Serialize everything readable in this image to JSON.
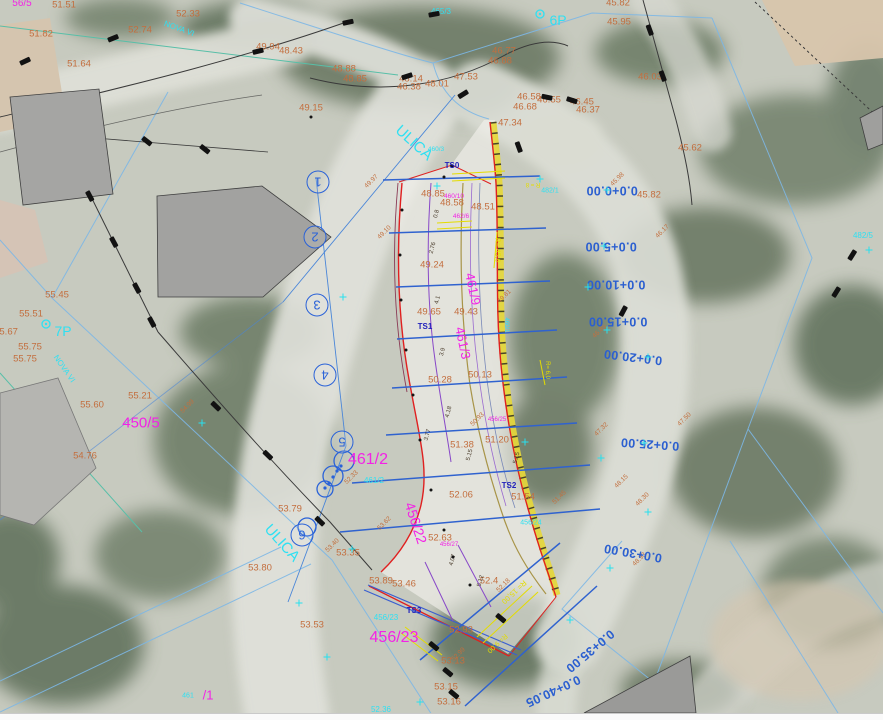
{
  "map": {
    "palette": {
      "station_blue": "#2b5fd0",
      "elevation_orange": "#c36e3e",
      "parcel_magenta": "#f322e6",
      "parcel_cyan": "#2fe0f2",
      "design_red": "#e02020",
      "highlight_yellow": "#e5d73a",
      "control_navy": "#2121bb"
    },
    "labels": {
      "streets": [
        {
          "t": "ULICA",
          "x": 414,
          "y": 143,
          "r": 42
        },
        {
          "t": "ULICA",
          "x": 282,
          "y": 543,
          "r": 48
        },
        {
          "t": "NOVA VI",
          "x": 179,
          "y": 29,
          "r": 20,
          "s": 8
        },
        {
          "t": "NOVA VI",
          "x": 64,
          "y": 369,
          "r": 55,
          "s": 8
        }
      ],
      "named_points": [
        {
          "t": "7P",
          "x": 63,
          "y": 331
        },
        {
          "t": "6P",
          "x": 558,
          "y": 20
        }
      ],
      "parcels_cyan": [
        {
          "t": "465/3",
          "x": 441,
          "y": 12
        },
        {
          "t": "482/5",
          "x": 863,
          "y": 236
        },
        {
          "t": "482/1",
          "x": 550,
          "y": 191,
          "s": 7
        },
        {
          "t": "461/2",
          "x": 374,
          "y": 481
        },
        {
          "t": "456/23",
          "x": 386,
          "y": 618
        },
        {
          "t": "456/24",
          "x": 531,
          "y": 523,
          "s": 7
        },
        {
          "t": "461",
          "x": 188,
          "y": 696,
          "s": 7
        },
        {
          "t": "52.36",
          "x": 381,
          "y": 710
        },
        {
          "t": "460/1",
          "x": 506,
          "y": 325,
          "r": 90,
          "s": 6
        },
        {
          "t": "460/3",
          "x": 436,
          "y": 150,
          "s": 6.5
        }
      ],
      "parcels_magenta": [
        {
          "t": "450/5",
          "x": 141,
          "y": 423
        },
        {
          "t": "461/2",
          "x": 368,
          "y": 460,
          "s": 16
        },
        {
          "t": "456/22",
          "x": 416,
          "y": 523,
          "s": 14,
          "r": 72
        },
        {
          "t": "456/23",
          "x": 394,
          "y": 638,
          "s": 16
        },
        {
          "t": "461/9",
          "x": 473,
          "y": 289,
          "s": 13,
          "r": 78
        },
        {
          "t": "461/3",
          "x": 463,
          "y": 343,
          "s": 13,
          "r": 78
        },
        {
          "t": "460/10",
          "x": 454,
          "y": 197,
          "s": 6.5
        },
        {
          "t": "462/6",
          "x": 461,
          "y": 217,
          "s": 6.5
        },
        {
          "t": "456/27",
          "x": 449,
          "y": 545,
          "s": 6
        },
        {
          "t": "456/25",
          "x": 497,
          "y": 420,
          "s": 6
        },
        {
          "t": "/1",
          "x": 208,
          "y": 695,
          "s": 13
        },
        {
          "t": "56/5",
          "x": 22,
          "y": 4,
          "s": 10
        }
      ],
      "spot_elevations": [
        {
          "t": "51.51",
          "x": 64,
          "y": 5
        },
        {
          "t": "52.33",
          "x": 188,
          "y": 14
        },
        {
          "t": "52.74",
          "x": 140,
          "y": 30
        },
        {
          "t": "51.82",
          "x": 41,
          "y": 34
        },
        {
          "t": "51.64",
          "x": 79,
          "y": 64
        },
        {
          "t": "49.94",
          "x": 268,
          "y": 47
        },
        {
          "t": "48.43",
          "x": 291,
          "y": 51
        },
        {
          "t": "48.88",
          "x": 344,
          "y": 69
        },
        {
          "t": "48.85",
          "x": 355,
          "y": 79
        },
        {
          "t": "48.14",
          "x": 411,
          "y": 79
        },
        {
          "t": "46.38",
          "x": 409,
          "y": 87
        },
        {
          "t": "48.01",
          "x": 437,
          "y": 84
        },
        {
          "t": "47.53",
          "x": 466,
          "y": 77
        },
        {
          "t": "46.77",
          "x": 504,
          "y": 51
        },
        {
          "t": "46.88",
          "x": 500,
          "y": 61
        },
        {
          "t": "49.15",
          "x": 311,
          "y": 108
        },
        {
          "t": "46.58",
          "x": 529,
          "y": 97
        },
        {
          "t": "46.55",
          "x": 549,
          "y": 100
        },
        {
          "t": "46.45",
          "x": 582,
          "y": 102
        },
        {
          "t": "46.68",
          "x": 525,
          "y": 107
        },
        {
          "t": "46.37",
          "x": 588,
          "y": 110
        },
        {
          "t": "47.34",
          "x": 510,
          "y": 123
        },
        {
          "t": "45.82",
          "x": 618,
          "y": 3
        },
        {
          "t": "45.95",
          "x": 619,
          "y": 22
        },
        {
          "t": "46.03",
          "x": 650,
          "y": 77
        },
        {
          "t": "45.62",
          "x": 690,
          "y": 148
        },
        {
          "t": "45.82",
          "x": 649,
          "y": 195
        },
        {
          "t": "48.85",
          "x": 433,
          "y": 194
        },
        {
          "t": "48.58",
          "x": 452,
          "y": 203
        },
        {
          "t": "48.51",
          "x": 483,
          "y": 207
        },
        {
          "t": "49.24",
          "x": 432,
          "y": 265
        },
        {
          "t": "49.65",
          "x": 429,
          "y": 312
        },
        {
          "t": "49.43",
          "x": 466,
          "y": 312
        },
        {
          "t": "50.28",
          "x": 440,
          "y": 380
        },
        {
          "t": "50.13",
          "x": 480,
          "y": 375
        },
        {
          "t": "51.38",
          "x": 462,
          "y": 445
        },
        {
          "t": "51.20",
          "x": 497,
          "y": 440
        },
        {
          "t": "52.06",
          "x": 461,
          "y": 495
        },
        {
          "t": "51.54",
          "x": 523,
          "y": 497
        },
        {
          "t": "52.63",
          "x": 440,
          "y": 538
        },
        {
          "t": "53.35",
          "x": 348,
          "y": 553
        },
        {
          "t": "53.79",
          "x": 290,
          "y": 509
        },
        {
          "t": "53.80",
          "x": 260,
          "y": 568
        },
        {
          "t": "53.89",
          "x": 381,
          "y": 581
        },
        {
          "t": "53.46",
          "x": 404,
          "y": 584
        },
        {
          "t": "52.4",
          "x": 489,
          "y": 581
        },
        {
          "t": "52.93",
          "x": 461,
          "y": 630
        },
        {
          "t": "53.13",
          "x": 453,
          "y": 661
        },
        {
          "t": "53.15",
          "x": 446,
          "y": 687
        },
        {
          "t": "53.16",
          "x": 449,
          "y": 702
        },
        {
          "t": "53.53",
          "x": 312,
          "y": 625
        },
        {
          "t": "55.45",
          "x": 57,
          "y": 295
        },
        {
          "t": "55.51",
          "x": 31,
          "y": 314
        },
        {
          "t": "55.67",
          "x": 6,
          "y": 332
        },
        {
          "t": "55.75",
          "x": 30,
          "y": 347
        },
        {
          "t": "55.75",
          "x": 25,
          "y": 359
        },
        {
          "t": "55.60",
          "x": 92,
          "y": 405
        },
        {
          "t": "55.21",
          "x": 140,
          "y": 396
        },
        {
          "t": "54.76",
          "x": 85,
          "y": 456
        }
      ],
      "minor_marks": [
        {
          "t": "49.97",
          "x": 372,
          "y": 182
        },
        {
          "t": "49.10",
          "x": 385,
          "y": 233
        },
        {
          "t": "49.81",
          "x": 505,
          "y": 297
        },
        {
          "t": "50.93",
          "x": 478,
          "y": 420
        },
        {
          "t": "47.32",
          "x": 602,
          "y": 430
        },
        {
          "t": "48.15",
          "x": 622,
          "y": 482
        },
        {
          "t": "48.30",
          "x": 643,
          "y": 500
        },
        {
          "t": "52.33",
          "x": 352,
          "y": 478
        },
        {
          "t": "53.40",
          "x": 333,
          "y": 546
        },
        {
          "t": "52.99",
          "x": 459,
          "y": 655
        },
        {
          "t": "52.18",
          "x": 504,
          "y": 586
        },
        {
          "t": "45.98",
          "x": 618,
          "y": 180
        },
        {
          "t": "46.17",
          "x": 663,
          "y": 232
        },
        {
          "t": "47.50",
          "x": 685,
          "y": 420
        },
        {
          "t": "46.85",
          "x": 600,
          "y": 332
        },
        {
          "t": "51.45",
          "x": 560,
          "y": 498
        },
        {
          "t": "48.93",
          "x": 640,
          "y": 560
        },
        {
          "t": "54.99",
          "x": 188,
          "y": 407
        },
        {
          "t": "53.62",
          "x": 385,
          "y": 524
        }
      ],
      "distance_marks": [
        {
          "t": "0.8",
          "x": 437,
          "y": 214
        },
        {
          "t": "2.76",
          "x": 433,
          "y": 248
        },
        {
          "t": "4.1",
          "x": 438,
          "y": 300
        },
        {
          "t": "3.9",
          "x": 443,
          "y": 352
        },
        {
          "t": "4.18",
          "x": 449,
          "y": 412
        },
        {
          "t": "3.77",
          "x": 428,
          "y": 435
        },
        {
          "t": "5.15",
          "x": 470,
          "y": 455
        },
        {
          "t": "5.15",
          "x": 517,
          "y": 458
        },
        {
          "t": "4.07",
          "x": 453,
          "y": 560
        },
        {
          "t": "5.12",
          "x": 481,
          "y": 581
        }
      ],
      "stations": [
        {
          "t": "0.0+0.00",
          "x": 612,
          "y": 190
        },
        {
          "t": "0.0+5.00",
          "x": 611,
          "y": 246
        },
        {
          "t": "0.0+10.00",
          "x": 616,
          "y": 284
        },
        {
          "t": "0.0+15.00",
          "x": 618,
          "y": 321
        },
        {
          "t": "0.0+20.00",
          "x": 633,
          "y": 357,
          "r": 187
        },
        {
          "t": "0.0+25.00",
          "x": 650,
          "y": 444,
          "r": 184
        },
        {
          "t": "0.0+30.00",
          "x": 633,
          "y": 553,
          "r": 190
        },
        {
          "t": "0.0+35.00",
          "x": 590,
          "y": 651,
          "r": 140
        },
        {
          "t": "0.0+40.05",
          "x": 553,
          "y": 691,
          "r": 155
        }
      ],
      "control_points": [
        {
          "t": "TS0",
          "x": 452,
          "y": 166
        },
        {
          "t": "TS1",
          "x": 425,
          "y": 327
        },
        {
          "t": "TS2",
          "x": 509,
          "y": 486
        },
        {
          "t": "TS3",
          "x": 414,
          "y": 611
        }
      ],
      "section_numbers": [
        {
          "t": "1",
          "x": 318,
          "y": 182
        },
        {
          "t": "2",
          "x": 315,
          "y": 237
        },
        {
          "t": "3",
          "x": 317,
          "y": 305
        },
        {
          "t": "4",
          "x": 325,
          "y": 375
        },
        {
          "t": "5",
          "x": 342,
          "y": 442
        },
        {
          "t": "6",
          "x": 302,
          "y": 535
        }
      ],
      "yellow_annotations": [
        {
          "t": "R= 45,6",
          "x": 497,
          "y": 250,
          "r": 90
        },
        {
          "t": "R = 8",
          "x": 533,
          "y": 184,
          "r": 180,
          "s": 6
        },
        {
          "t": "R= 15,00",
          "x": 514,
          "y": 592,
          "r": 137,
          "s": 7.5
        },
        {
          "t": "R= 9,00",
          "x": 497,
          "y": 643,
          "r": 137
        },
        {
          "t": "R= 6,0",
          "x": 547,
          "y": 370,
          "r": 90,
          "s": 6
        }
      ]
    },
    "symbols": {
      "survey_marks": [
        [
          113,
          38,
          -22
        ],
        [
          25,
          61,
          -25
        ],
        [
          258,
          51,
          -13
        ],
        [
          348,
          22,
          -12
        ],
        [
          434,
          14,
          -10
        ],
        [
          407,
          76,
          -18
        ],
        [
          463,
          94,
          -32
        ],
        [
          519,
          147,
          70
        ],
        [
          547,
          97,
          12
        ],
        [
          572,
          100,
          18
        ],
        [
          650,
          30,
          70
        ],
        [
          663,
          76,
          70
        ],
        [
          147,
          141,
          38
        ],
        [
          205,
          149,
          38
        ],
        [
          90,
          196,
          62
        ],
        [
          114,
          242,
          62
        ],
        [
          137,
          288,
          62
        ],
        [
          152,
          322,
          62
        ],
        [
          216,
          406,
          44
        ],
        [
          268,
          455,
          44
        ],
        [
          320,
          521,
          44
        ],
        [
          434,
          646,
          40
        ],
        [
          448,
          672,
          40
        ],
        [
          454,
          694,
          40
        ],
        [
          501,
          618,
          40
        ],
        [
          836,
          292,
          -58
        ],
        [
          852,
          255,
          -58
        ],
        [
          623,
          311,
          -62
        ]
      ],
      "cyan_crosses": [
        [
          607,
          190
        ],
        [
          604,
          246
        ],
        [
          588,
          287
        ],
        [
          607,
          330
        ],
        [
          648,
          357
        ],
        [
          601,
          458
        ],
        [
          648,
          512
        ],
        [
          610,
          568
        ],
        [
          570,
          620
        ],
        [
          420,
          702
        ],
        [
          327,
          657
        ],
        [
          540,
          179
        ],
        [
          437,
          186
        ],
        [
          525,
          442
        ],
        [
          352,
          549
        ],
        [
          299,
          603
        ],
        [
          644,
          443
        ],
        [
          869,
          250
        ],
        [
          343,
          297
        ],
        [
          202,
          423
        ]
      ],
      "point_dots": [
        [
          402,
          210
        ],
        [
          400,
          255
        ],
        [
          401,
          300
        ],
        [
          406,
          350
        ],
        [
          413,
          395
        ],
        [
          420,
          440
        ],
        [
          431,
          490
        ],
        [
          444,
          530
        ],
        [
          453,
          557
        ],
        [
          470,
          585
        ],
        [
          444,
          177
        ],
        [
          311,
          117
        ]
      ]
    }
  }
}
